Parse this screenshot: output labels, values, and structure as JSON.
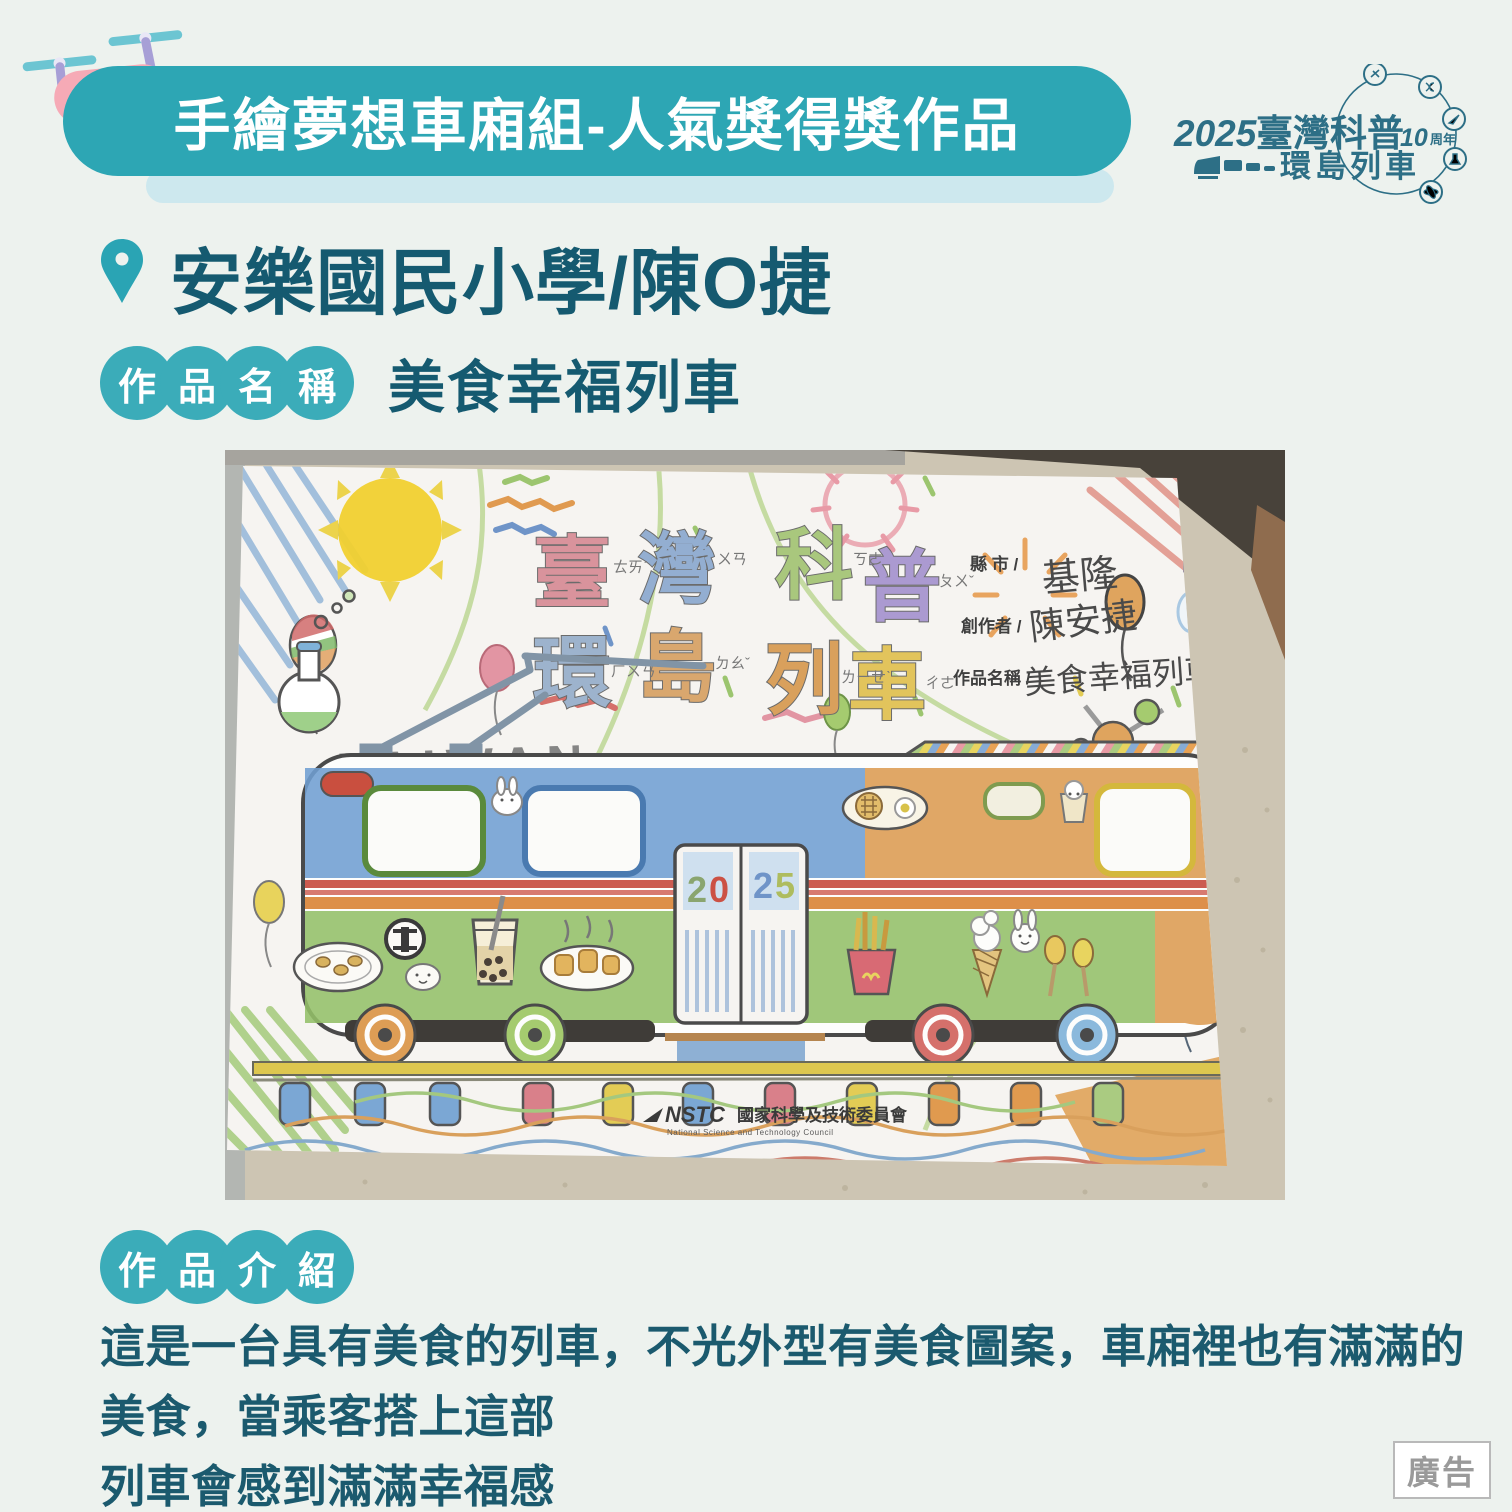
{
  "colors": {
    "page_bg": "#edf2ee",
    "banner_teal": "#2da6b4",
    "banner_shadow": "#cde8ee",
    "badge_teal": "#3bacb9",
    "dark_teal_text": "#155a70",
    "logo_steel_blue": "#2d6f86",
    "ad_gray": "#9a9a9a"
  },
  "banner": {
    "title": "手繪夢想車廂組-人氣獎得獎作品"
  },
  "logo": {
    "year": "2025",
    "title": "臺灣科普",
    "anniversary_number": "10",
    "anniversary_unit": "周年",
    "subtitle": "環島列車"
  },
  "winner": {
    "school_and_author": "安樂國民小學/陳O捷"
  },
  "work_name_badge": {
    "chars": [
      "作",
      "品",
      "名",
      "稱"
    ]
  },
  "work_name_value": "美食幸福列車",
  "intro_badge": {
    "chars": [
      "作",
      "品",
      "介",
      "紹"
    ]
  },
  "intro_text_line1": "這是一台具有美食的列車，不光外型有美食圖案，車廂裡也有滿滿的美食，當乘客搭上這部",
  "intro_text_line2": "列車會感到滿滿幸福感",
  "ad_label": "廣告",
  "photo": {
    "taiwan_label": "TAIWAN",
    "title_chars": [
      "臺",
      "灣",
      "科",
      "普",
      "環",
      "島",
      "列",
      "車"
    ],
    "zhuyin": [
      "ㄊㄞˊ",
      "ㄨㄢ",
      "ㄎㄜ",
      "ㄆㄨˇ",
      "ㄏㄨㄢˊ",
      "ㄉㄠˇ",
      "ㄌㄧㄝˋ",
      "ㄔㄜ"
    ],
    "form": {
      "county_label": "縣 市 /",
      "county_value": "基隆",
      "creator_label": "創作者 /",
      "creator_value": "陳安捷",
      "work_label": "作品名稱 /",
      "work_value": "美食幸福列車"
    },
    "door_digits": [
      "2",
      "0",
      "2",
      "5"
    ],
    "nstc_abbr": "NSTC",
    "nstc_zh": "國家科學及技術委員會",
    "nstc_en": "National Science and Technology Council"
  }
}
